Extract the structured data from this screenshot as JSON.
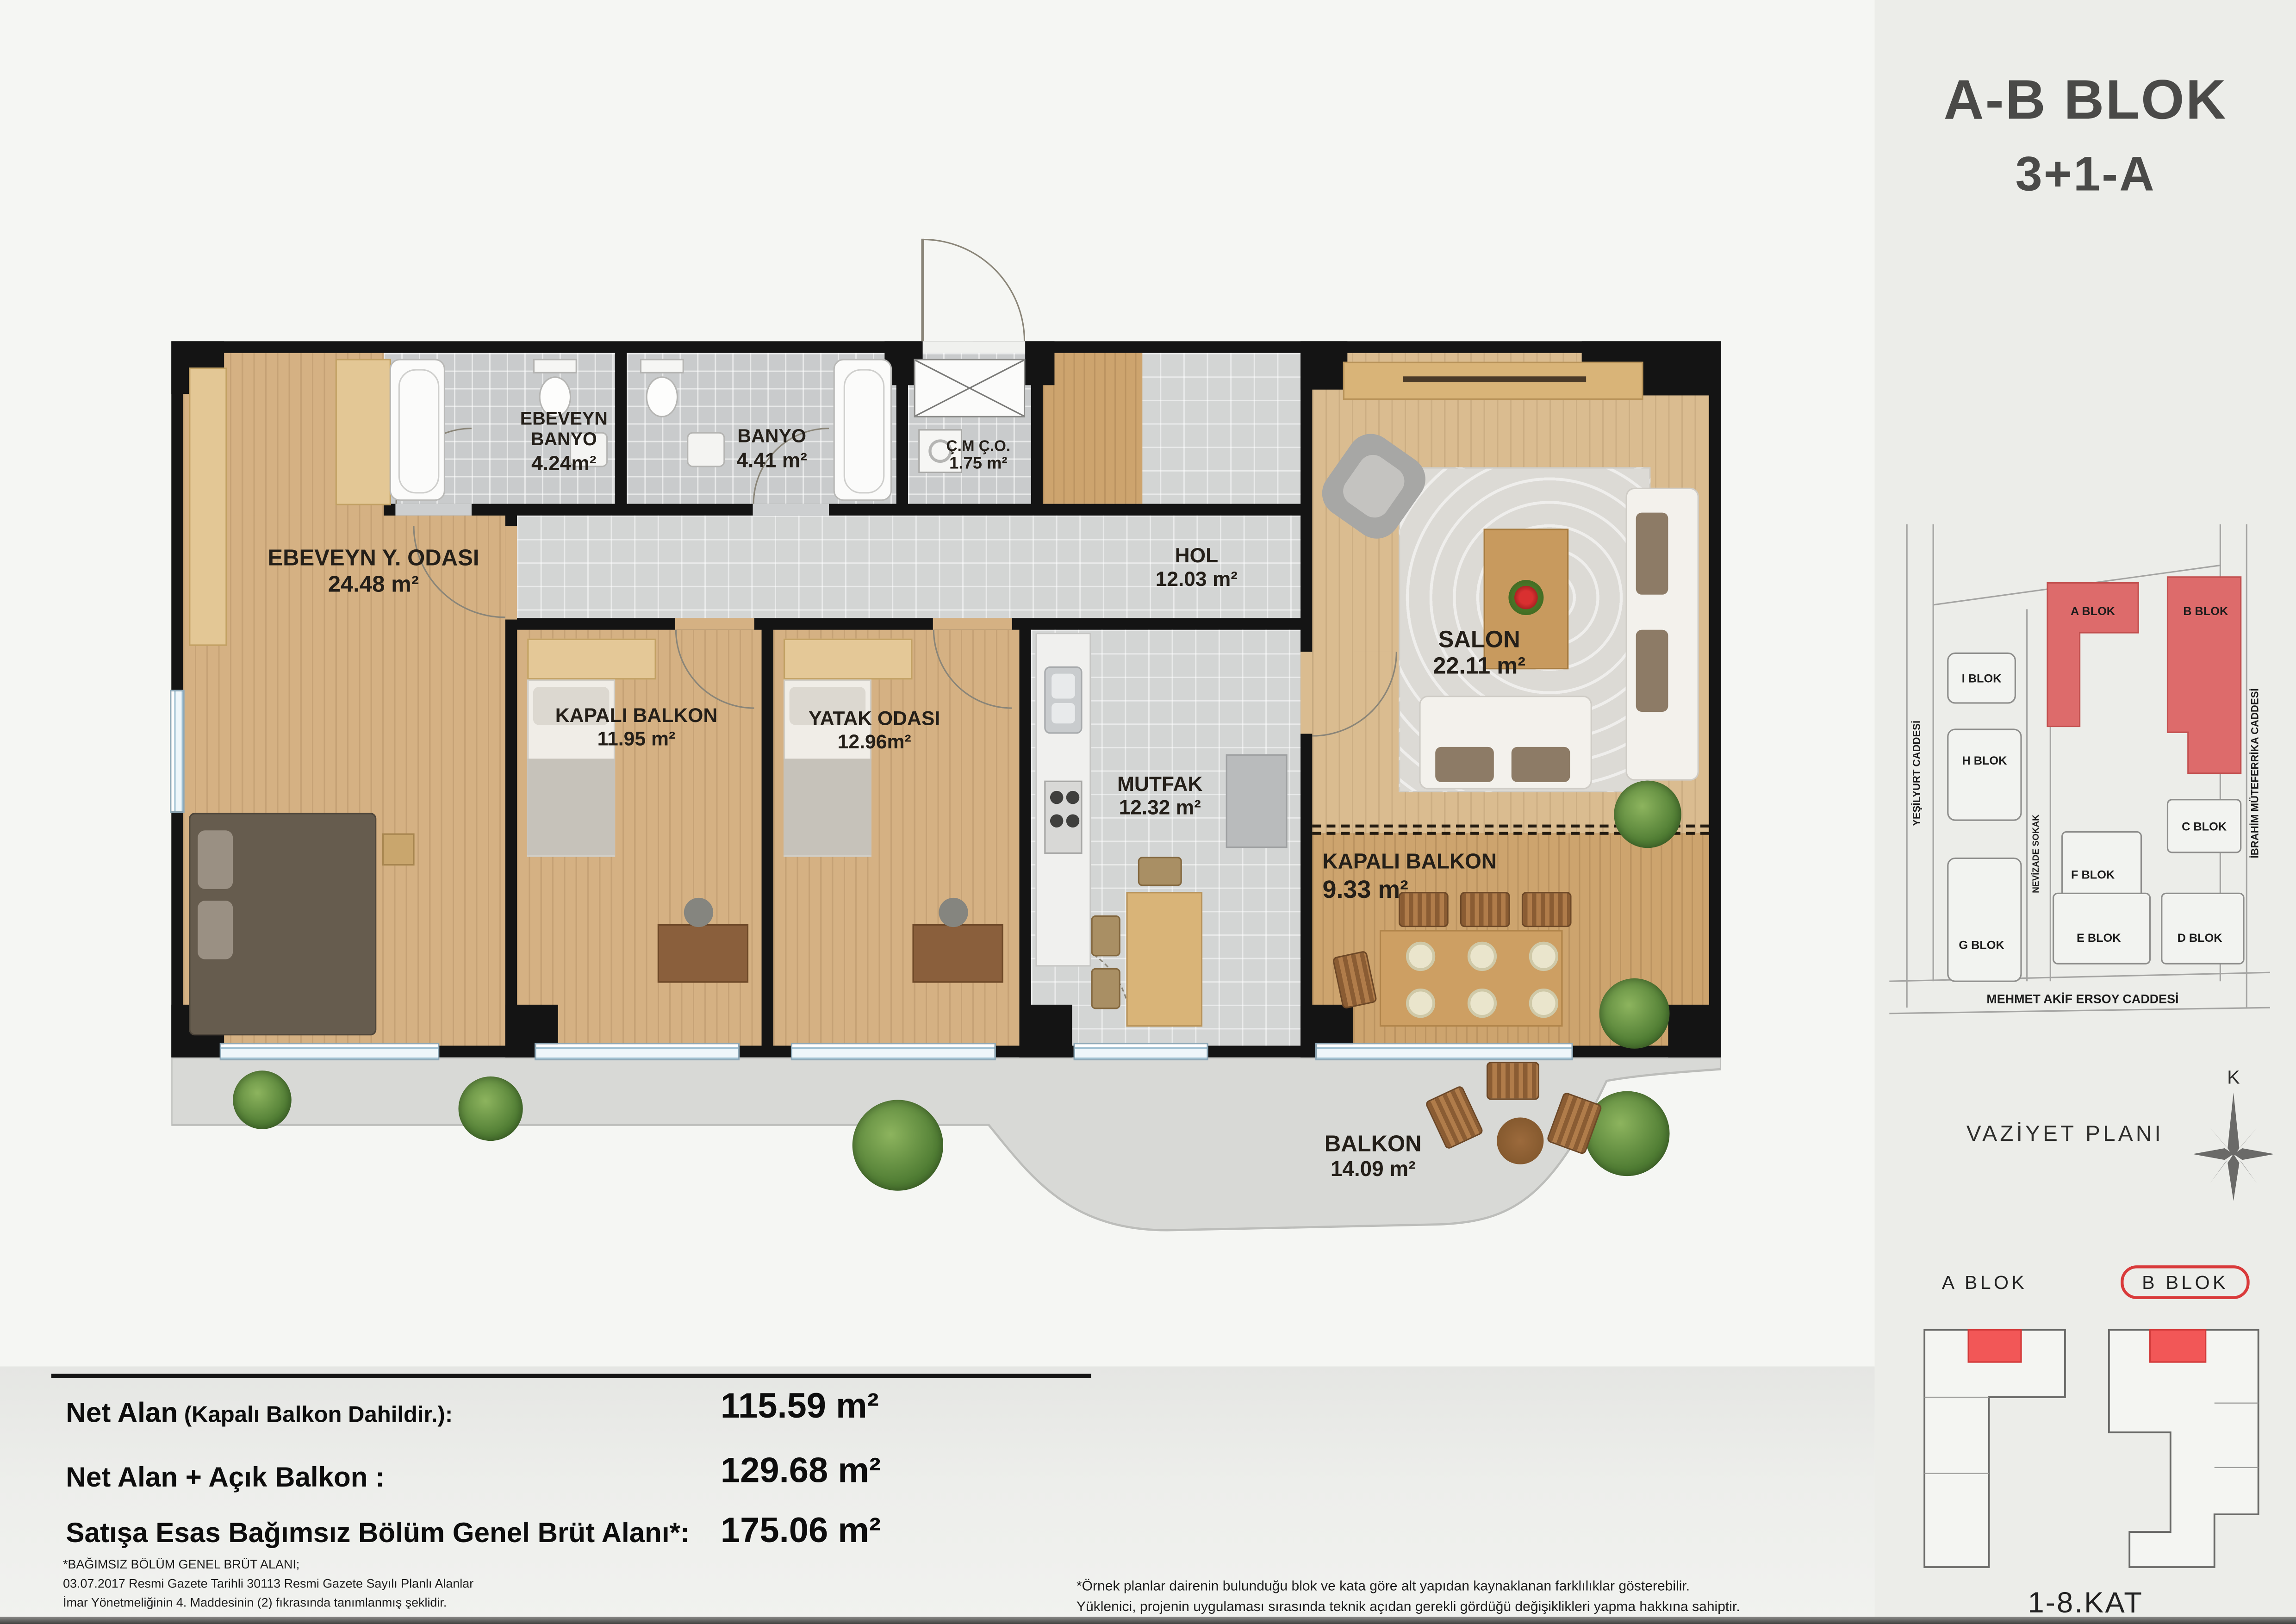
{
  "header": {
    "line1": "A-B BLOK",
    "line2": "3+1-A"
  },
  "rooms": [
    {
      "name": "EBEVEYN BANYO",
      "area": "4.24m²"
    },
    {
      "name": "BANYO",
      "area": "4.41 m²"
    },
    {
      "name": "Ç.M Ç.O.",
      "area": "1.75 m²"
    },
    {
      "name": "HOL",
      "area": "12.03 m²"
    },
    {
      "name": "EBEVEYN Y. ODASI",
      "area": "24.48 m²"
    },
    {
      "name": "KAPALI BALKON",
      "area": "11.95 m²"
    },
    {
      "name": "YATAK ODASI",
      "area": "12.96m²"
    },
    {
      "name": "MUTFAK",
      "area": "12.32 m²"
    },
    {
      "name": "SALON",
      "area": "22.11 m²"
    },
    {
      "name": "KAPALI BALKON",
      "area": "9.33 m²"
    },
    {
      "name": "BALKON",
      "area": "14.09 m²"
    }
  ],
  "summary": {
    "rows": [
      {
        "label": "Net Alan",
        "label_suffix": " (Kapalı Balkon Dahildir.):",
        "value": "115.59 m²"
      },
      {
        "label": "Net Alan + Açık Balkon :",
        "label_suffix": "",
        "value": "129.68 m²"
      },
      {
        "label": "Satışa Esas Bağımsız Bölüm Genel Brüt Alanı*:",
        "label_suffix": "",
        "value": "175.06 m²"
      }
    ],
    "footnote_left": [
      "*BAĞIMSIZ BÖLÜM GENEL BRÜT ALANI;",
      "03.07.2017 Resmi Gazete Tarihli 30113 Resmi Gazete Sayılı  Planlı Alanlar",
      "İmar Yönetmeliğinin 4. Maddesinin (2) fıkrasında tanımlanmış şeklidir."
    ],
    "footnote_right": [
      "*Örnek planlar dairenin bulunduğu blok ve kata göre alt yapıdan kaynaklanan farklılıklar gösterebilir.",
      "Yüklenici, projenin uygulaması sırasında teknik açıdan gerekli gördüğü değişiklikleri yapma hakkına sahiptir."
    ]
  },
  "site_plan": {
    "caption": "VAZİYET PLANI",
    "compass_label": "K",
    "streets": [
      "YEŞİLYURT CADDESİ",
      "NEVİZADE SOKAK",
      "İBRAHİM MÜTEFERRİKA  CADDESİ",
      "MEHMET AKİF ERSOY CADDESİ"
    ],
    "blocks": [
      "I BLOK",
      "H BLOK",
      "G BLOK",
      "A BLOK",
      "B BLOK",
      "C BLOK",
      "F BLOK",
      "E BLOK",
      "D BLOK"
    ]
  },
  "key_plan": {
    "a_label": "A BLOK",
    "b_label": "B BLOK",
    "floor_label": "1-8.KAT"
  },
  "colors": {
    "site_highlight": "#dd6b6b",
    "unit_highlight": "#f25757",
    "wall": "#141414",
    "wood": "#d5b183",
    "tile": "#cdcfd0"
  }
}
